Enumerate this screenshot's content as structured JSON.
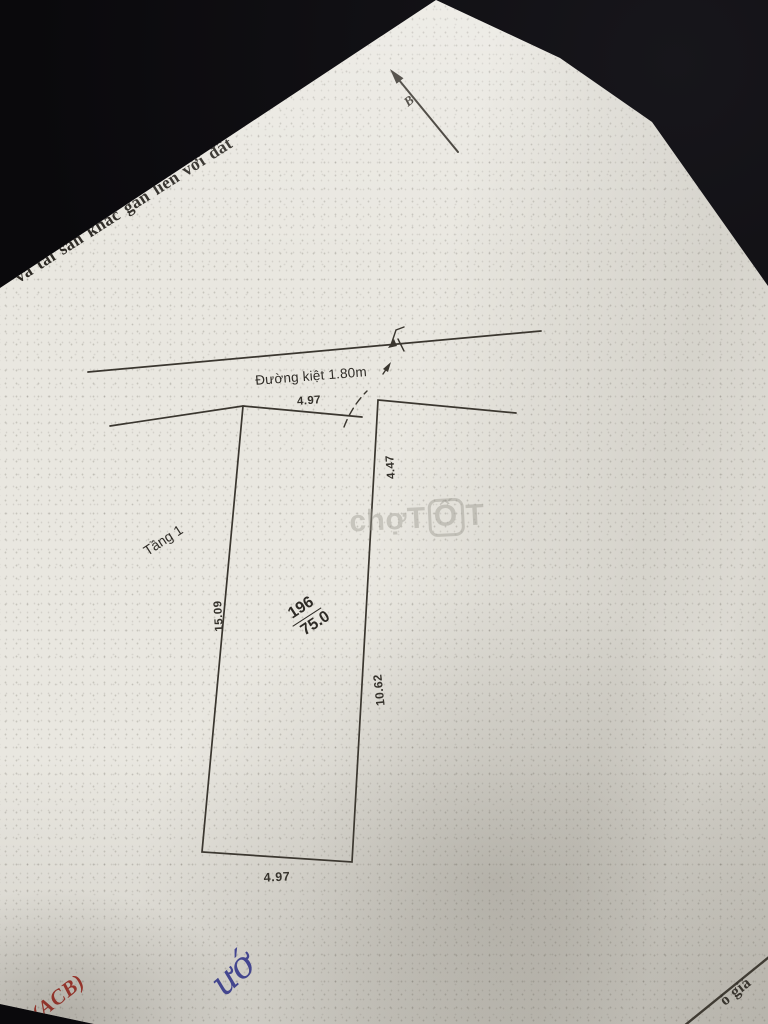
{
  "page": {
    "side_text": "và tài sản khác gắn liền với đất",
    "north_symbol": "B",
    "road_label": "Đường kiệt 1.80m",
    "floor_label": "Tầng 1",
    "parcel_number": "196",
    "parcel_area": "75.0",
    "dim_top": "4.97",
    "dim_left": "15.09",
    "dim_right_upper": "4.47",
    "dim_right": "10.62",
    "dim_bottom": "4.97",
    "watermark_prefix": "chợ",
    "watermark_t1": "T",
    "watermark_o": "Ố",
    "watermark_t2": "T",
    "red_stamp": "ỷ(ACB)",
    "blue_handwriting": "ướ",
    "bottom_right_text": "ó giá",
    "colors": {
      "paper": "#e9e7e0",
      "ink": "#3a362f",
      "red": "#b23129",
      "blue": "#43479f",
      "watermark": "#9e9b92"
    }
  }
}
